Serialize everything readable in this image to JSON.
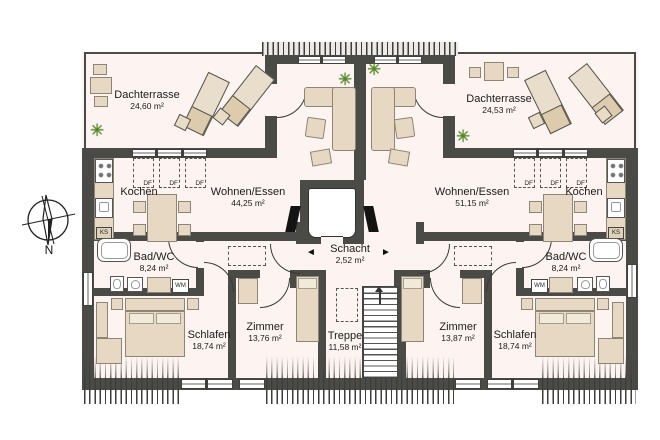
{
  "colors": {
    "wall": "#4a4a47",
    "floor": "#fdf4f1",
    "furniture": "#e6d8c2",
    "plant": "#4e8c1c"
  },
  "compass": {
    "label": "N"
  },
  "tags": {
    "roof_window": "DF",
    "washing_machine": "WM",
    "fridge": "KS"
  },
  "core": {
    "shaft_label": "Schacht",
    "shaft_area": "2,52 m²",
    "stairs_label": "Treppe",
    "stairs_area": "11,58 m²",
    "arrow_left": "◄",
    "arrow_right": "►"
  },
  "left": {
    "terrace_label": "Dachterrasse",
    "terrace_area": "24,60 m²",
    "kitchen_label": "Kochen",
    "living_label": "Wohnen/Essen",
    "living_area": "44,25 m²",
    "bath_label": "Bad/WC",
    "bath_area": "8,24 m²",
    "bedroom_label": "Schlafen",
    "bedroom_area": "18,74 m²",
    "room_label": "Zimmer",
    "room_area": "13,76 m²"
  },
  "right": {
    "terrace_label": "Dachterrasse",
    "terrace_area": "24,53 m²",
    "kitchen_label": "Kochen",
    "living_label": "Wohnen/Essen",
    "living_area": "51,15 m²",
    "bath_label": "Bad/WC",
    "bath_area": "8,24 m²",
    "bedroom_label": "Schlafen",
    "bedroom_area": "18,74 m²",
    "room_label": "Zimmer",
    "room_area": "13,87 m²"
  }
}
